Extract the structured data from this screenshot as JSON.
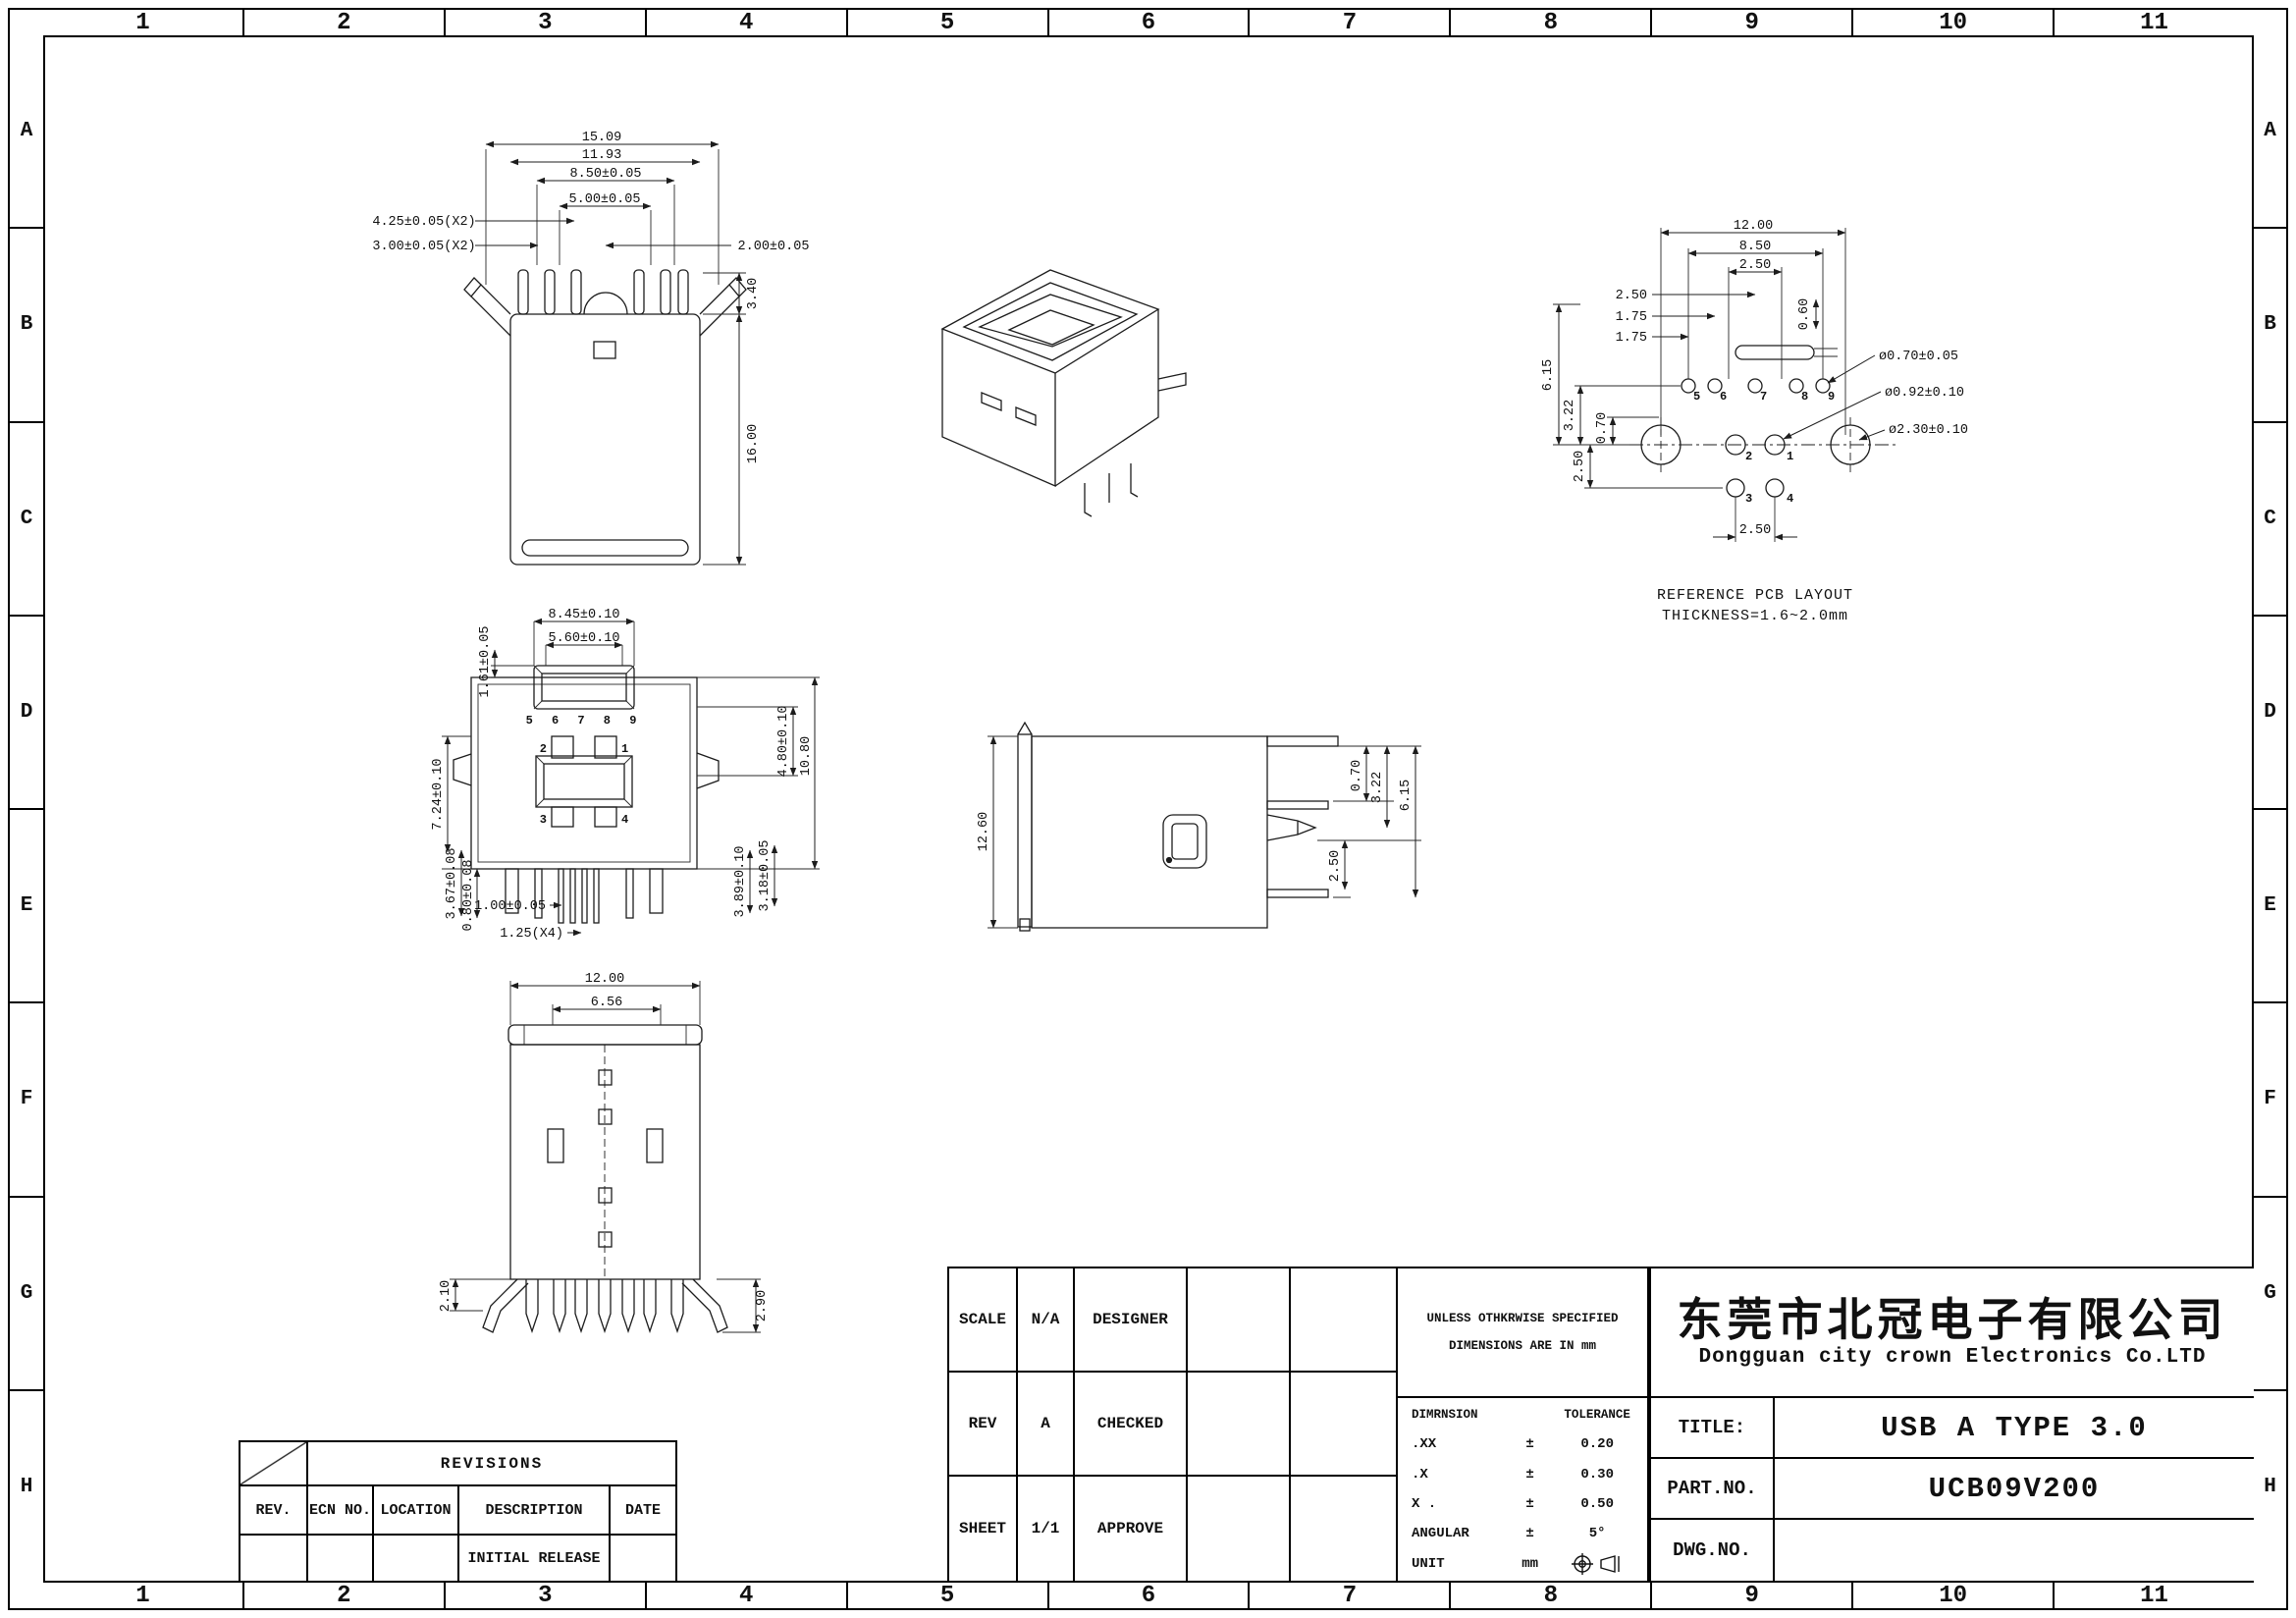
{
  "sheet": {
    "columns": [
      "1",
      "2",
      "3",
      "4",
      "5",
      "6",
      "7",
      "8",
      "9",
      "10",
      "11"
    ],
    "rows": [
      "A",
      "B",
      "C",
      "D",
      "E",
      "F",
      "G",
      "H"
    ]
  },
  "views": {
    "top_view": {
      "dims": {
        "d1": "15.09",
        "d2": "11.93",
        "d3": "8.50±0.05",
        "d4": "5.00±0.05",
        "d5": "4.25±0.05(X2)",
        "d6": "3.00±0.05(X2)",
        "d7": "2.00±0.05",
        "d8": "3.40",
        "d9": "16.00"
      }
    },
    "pcb_layout": {
      "caption_line1": "REFERENCE PCB LAYOUT",
      "caption_line2": "THICKNESS=1.6~2.0mm",
      "dims": {
        "w1": "12.00",
        "w2": "8.50",
        "w3": "2.50",
        "l1": "2.50",
        "l2": "1.75",
        "l3": "1.75",
        "v1": "0.60",
        "v2": "6.15",
        "v3": "3.22",
        "v4": "0.70",
        "v5": "2.50",
        "b1": "2.50",
        "r1": "ø0.70±0.05",
        "r2": "ø0.92±0.10",
        "r3": "ø2.30±0.10"
      },
      "pins_top": [
        "5",
        "6",
        "7",
        "8",
        "9"
      ],
      "pin_1": "1",
      "pin_2": "2",
      "pin_3": "3",
      "pin_4": "4"
    },
    "front_view": {
      "dims": {
        "d1": "8.45±0.10",
        "d2": "5.60±0.10",
        "d3": "1.61±0.05",
        "d4": "7.24±0.10",
        "d5": "4.80±0.10",
        "d6": "10.80",
        "d7": "3.67±0.08",
        "d8": "0.80±0.08",
        "d9": "1.00±0.05",
        "d10": "1.25(X4)",
        "d11": "3.89±0.10",
        "d12": "3.18±0.05"
      },
      "pin_row": "5 6 7 8 9",
      "pad_1": "1",
      "pad_2": "2",
      "pad_3": "3",
      "pad_4": "4"
    },
    "side_view": {
      "dims": {
        "d1": "12.60",
        "d2": "0.70",
        "d3": "3.22",
        "d4": "6.15",
        "d5": "2.50"
      }
    },
    "bottom_view": {
      "dims": {
        "d1": "12.00",
        "d2": "6.56",
        "d3": "2.10",
        "d4": "2.90"
      }
    }
  },
  "revisions_table": {
    "title": "REVISIONS",
    "headers": [
      "REV.",
      "ECN NO.",
      "LOCATION",
      "DESCRIPTION",
      "DATE"
    ],
    "row1_description": "INITIAL RELEASE"
  },
  "info_table": {
    "scale_label": "SCALE",
    "scale_value": "N/A",
    "designer_label": "DESIGNER",
    "rev_label": "REV",
    "rev_value": "A",
    "checked_label": "CHECKED",
    "sheet_label": "SHEET",
    "sheet_value": "1/1",
    "approve_label": "APPROVE"
  },
  "tolerance_block": {
    "note_line1": "UNLESS OTHKRWISE SPECIFIED",
    "note_line2": "DIMENSIONS ARE IN mm",
    "col_dimension": "DIMRNSION",
    "col_tolerance": "TOLERANCE",
    "r1_dim": ".XX",
    "r1_pm": "±",
    "r1_tol": "0.20",
    "r2_dim": ".X",
    "r2_pm": "±",
    "r2_tol": "0.30",
    "r3_dim": "X .",
    "r3_pm": "±",
    "r3_tol": "0.50",
    "r4_dim": "ANGULAR",
    "r4_pm": "±",
    "r4_tol": "5°",
    "r5_dim": "UNIT",
    "r5_pm": "mm"
  },
  "title_block": {
    "company_cn": "东莞市北冠电子有限公司",
    "company_en": "Dongguan city crown Electronics Co.LTD",
    "title_label": "TITLE:",
    "title_value": "USB A TYPE 3.0",
    "part_label": "PART.NO.",
    "part_value": "UCB09V200",
    "dwg_label": "DWG.NO.",
    "dwg_value": ""
  }
}
